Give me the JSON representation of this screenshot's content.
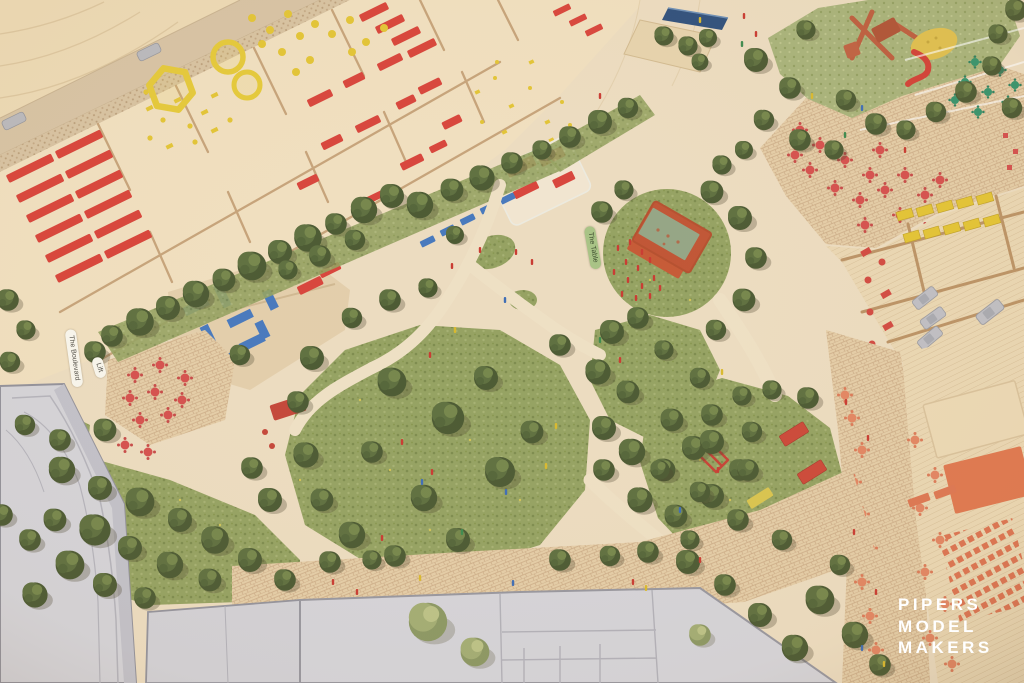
{
  "scene": {
    "type": "photograph",
    "subject": "Aerial view of an architectural scale model: central park with miniature trees and event stage, market stalls, cafe tables, playground, parking and gray buildings"
  },
  "model_labels": {
    "boulevard": "The Boulevard",
    "lift": "Lift",
    "table": "The Table"
  },
  "watermark": {
    "lines": [
      "PIPERS",
      "MODEL",
      "MAKERS"
    ]
  },
  "colors": {
    "base_wood": "#ecdcc0",
    "plywood": "#e9d5b1",
    "lawn_green": "#95a262",
    "tree_green": "#4c5a33",
    "accent_red": "#d8453c",
    "accent_coral": "#e08560",
    "accent_yellow": "#e4c73c",
    "accent_blue": "#4879bd",
    "table_green": "#37946d",
    "building_gray": "#d4d3d8",
    "brick": "#e4cda7",
    "water_blue": "#30517d",
    "watermark_white": "#ffffff"
  }
}
